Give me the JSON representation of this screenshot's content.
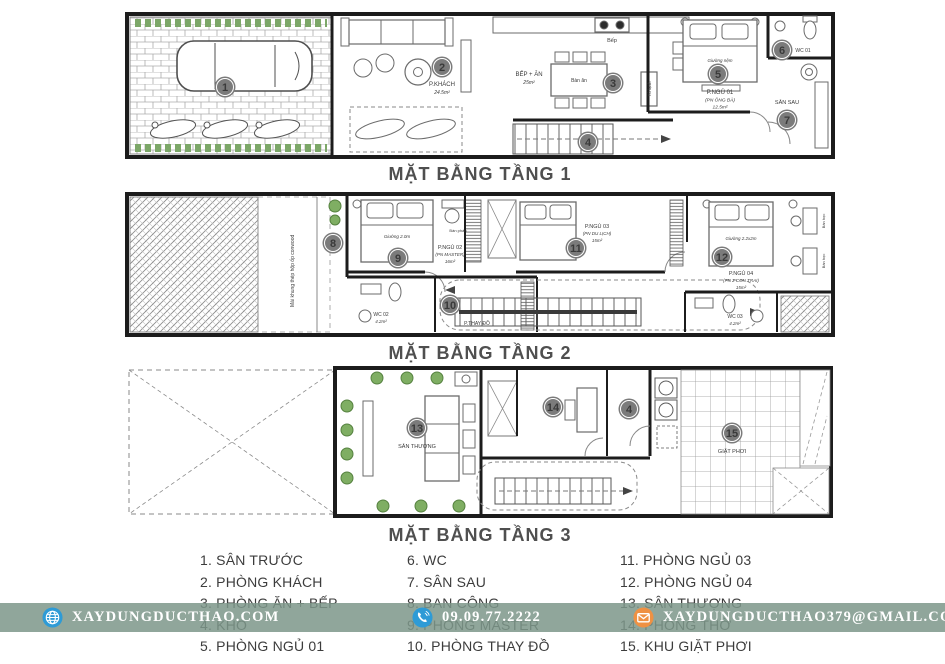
{
  "titles": {
    "floor1": "MẶT BẰNG TẦNG 1",
    "floor2": "MẶT BẰNG TẦNG 2",
    "floor3": "MẶT BẰNG TẦNG 3"
  },
  "markers": [
    "1",
    "2",
    "3",
    "4",
    "5",
    "6",
    "7",
    "8",
    "9",
    "10",
    "11",
    "12",
    "13",
    "14",
    "15"
  ],
  "plan1": {
    "living_room": "P.KHÁCH",
    "living_area": "24.5m²",
    "kitchen_dining": "BẾP + ĂN",
    "kitchen_area": "25m²",
    "dining_table": "Bàn ăn",
    "stove": "Bếp",
    "fridge": "Tủ lạnh",
    "bedroom": "P.NGỦ 01",
    "bedroom_sub": "(PN ÔNG BÀ)",
    "bedroom_area": "12.5m²",
    "bed": "Giường nệm",
    "wc": "WC 01",
    "backyard": "SÂN SAU"
  },
  "plan2": {
    "roof_note": "Mái khung thép hộp ốp conwood",
    "master_bedroom": "P.NGỦ 02",
    "master_sub": "(PN MASTER)",
    "master_area": "16m²",
    "master_bed": "Giường 2.0m",
    "vanity": "Bàn phấn",
    "wc2": "WC 02",
    "wc2_area": "4.2m²",
    "dressing": "P.THAY ĐỒ",
    "bedroom3": "P.NGỦ 03",
    "bedroom3_sub": "(PN DU LỊCH)",
    "bedroom3_area": "15m²",
    "bedroom4": "P.NGỦ 04",
    "bedroom4_sub": "(PN 2 CON TRAI)",
    "bedroom4_area": "15m²",
    "bed4": "Giường 2.2x2m",
    "desk": "Bàn học",
    "wc3": "WC 03",
    "wc3_area": "4.2m²"
  },
  "plan3": {
    "terrace": "SÂN THƯỢNG",
    "laundry": "GIẶT PHƠI"
  },
  "legend": {
    "columns": [
      {
        "items": [
          "1. SÂN TRƯỚC",
          "2. PHÒNG KHÁCH",
          "3. PHÒNG ĂN + BẾP",
          "4. KHO",
          "5. PHÒNG NGỦ 01"
        ]
      },
      {
        "items": [
          "6. WC",
          "7. SÂN SAU",
          "8. BAN CÔNG",
          "9. PHÒNG MASTER",
          "10. PHÒNG THAY ĐỒ"
        ]
      },
      {
        "items": [
          "11. PHÒNG NGỦ 03",
          "12. PHÒNG NGỦ 04",
          "13. SÂN THƯỢNG",
          "14. PHÒNG THỜ",
          "15. KHU GIẶT PHƠI"
        ]
      }
    ]
  },
  "footer": {
    "website": "XAYDUNGDUCTHAO.COM",
    "phone": "09.09.77.2222",
    "email": "XAYDUNGDUCTHAO379@GMAIL.COM"
  },
  "colors": {
    "wall": "#1c1c1c",
    "marker": "#7b7b7b",
    "plant_green": "#6f9e57",
    "footer_bg": "#7c968a",
    "globe_icon": "#2e9bd6",
    "phone_icon": "#2e9bd6",
    "email_icon": "#ef9143"
  }
}
